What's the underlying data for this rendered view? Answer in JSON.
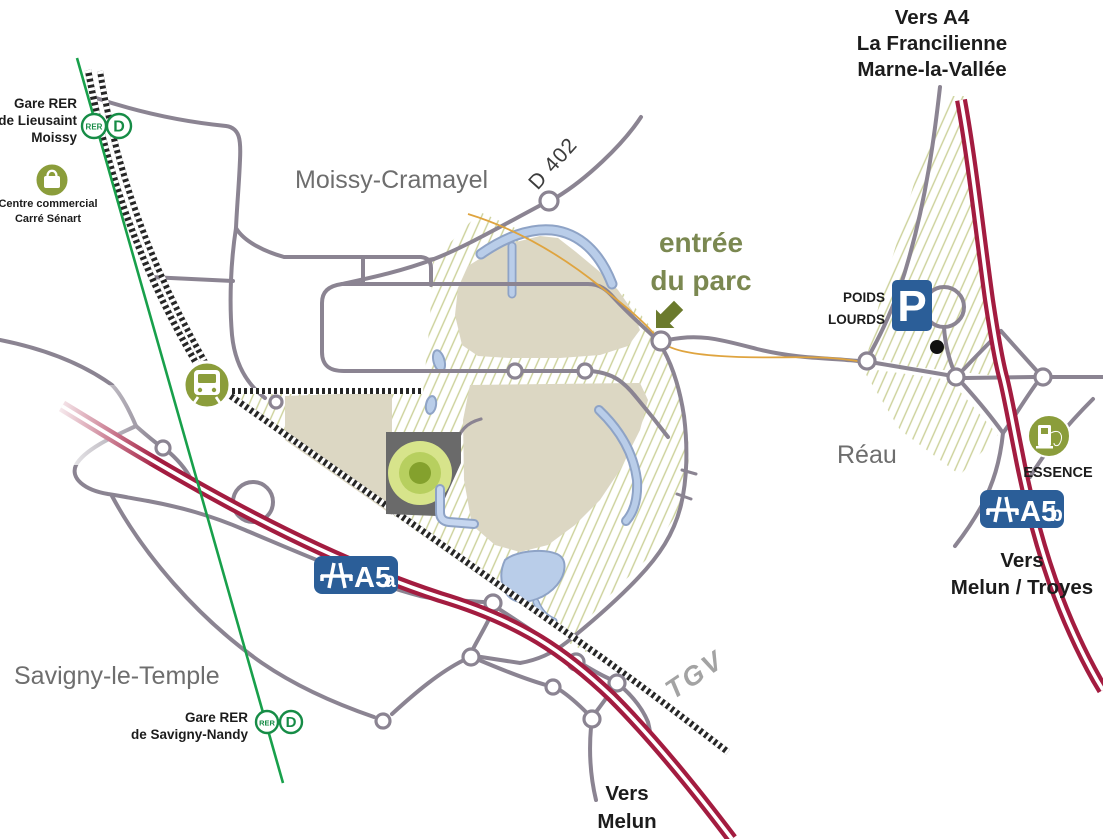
{
  "colors": {
    "motorway": "#a31c40",
    "road": "#8b8492",
    "railway": "#262626",
    "rer_line_green": "#18a04b",
    "olive_icon": "#8b9d3b",
    "olive_text": "#7b8851",
    "arrow_olive": "#6b7a2d",
    "park_beige": "#dcd7c3",
    "hatch_olive": "#ccd19a",
    "water_fill": "#b9cde9",
    "water_stroke": "#8ea3c6",
    "sign_blue": "#2b5e98",
    "trail_orange": "#dfa43f",
    "building_gray": "#6a6a6a",
    "target_outer": "#d7e48b",
    "target_mid": "#b7cf5f",
    "target_inner": "#84a12d"
  },
  "places": {
    "moissy_cramayel": "Moissy-Cramayel",
    "savigny_le_temple": "Savigny-le-Temple",
    "reau": "Réau"
  },
  "directions": {
    "vers_a4": [
      "Vers A4",
      "La Francilienne",
      "Marne-la-Vallée"
    ],
    "vers_melun_troyes": [
      "Vers",
      "Melun / Troyes"
    ],
    "vers_melun": [
      "Vers",
      "Melun"
    ]
  },
  "stations": {
    "badge_rer": "RER",
    "badge_line": "D",
    "lieusaint": [
      "Gare RER",
      "de Lieusaint",
      "Moissy"
    ],
    "savigny_nandy": [
      "Gare RER",
      "de Savigny-Nandy"
    ]
  },
  "pois": {
    "centre_commercial": [
      "Centre commercial",
      "Carré Sénart"
    ],
    "entree_du_parc": [
      "entrée",
      "du parc"
    ],
    "poids_lourds": [
      "POIDS",
      "LOURDS"
    ],
    "parking": "P",
    "essence": "ESSENCE"
  },
  "roads": {
    "d402": "D 402",
    "a5a": {
      "name": "A5",
      "suffix": "a"
    },
    "a5b": {
      "name": "A5",
      "suffix": "b"
    },
    "tgv": "TGV"
  }
}
